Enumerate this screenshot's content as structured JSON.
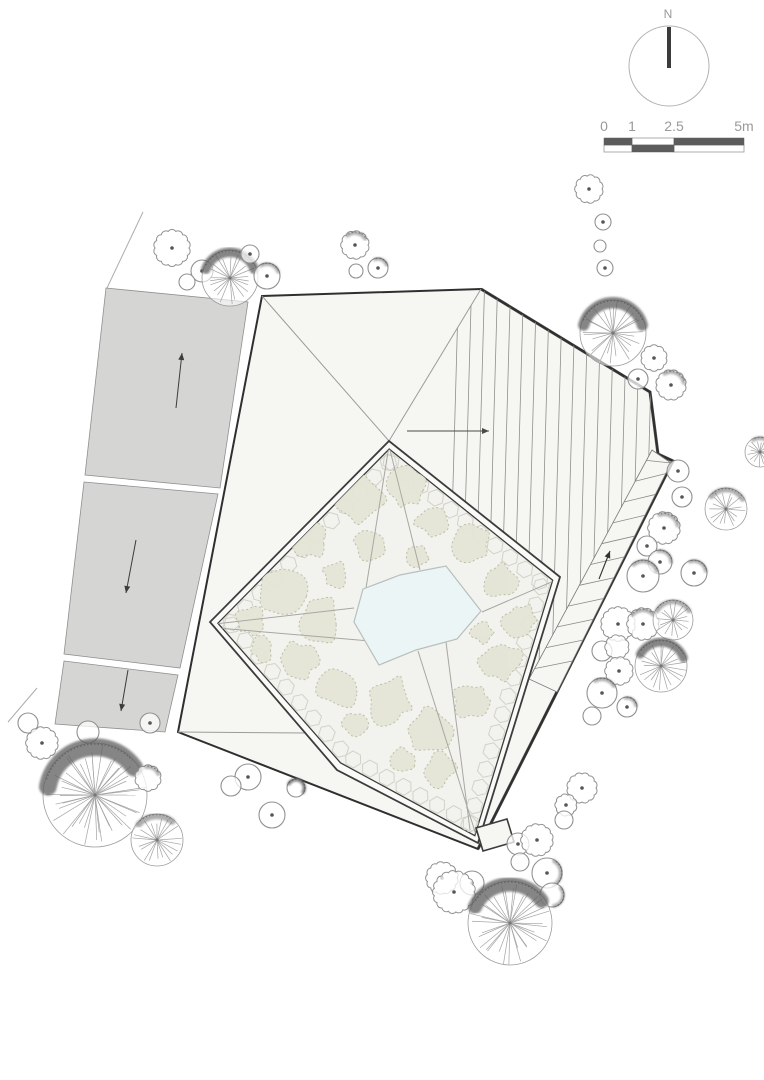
{
  "drawing_type": "architectural site plan / roof plan",
  "north_arrow": {
    "label": "N",
    "cx": 669,
    "cy": 66,
    "r": 40,
    "needle_y1": 27,
    "needle_y2": 68
  },
  "scale_bar": {
    "labels": [
      "0",
      "1",
      "2.5",
      "5m"
    ],
    "label_x": [
      604,
      632,
      674,
      744
    ],
    "label_y": 131,
    "x0": 604,
    "bar_y": 138,
    "row_h": 7,
    "unit_px": 28,
    "dark_cells": [
      {
        "from": 0,
        "to": 1,
        "row": 0
      },
      {
        "from": 1,
        "to": 2.5,
        "row": 1
      },
      {
        "from": 2.5,
        "to": 5,
        "row": 0
      }
    ],
    "light_cells": [
      {
        "from": 1,
        "to": 2.5,
        "row": 0
      },
      {
        "from": 0,
        "to": 1,
        "row": 1
      },
      {
        "from": 2.5,
        "to": 5,
        "row": 1
      }
    ]
  },
  "colors": {
    "background": "#ffffff",
    "road_fill": "#d5d5d3",
    "road_edge": "#8f8f8f",
    "roof_fill": "#f6f6f3",
    "roof_outline": "#2f2f2f",
    "ridge_line": "#9b9b9b",
    "hatch_line": "#8f8f8c",
    "courtyard_fill": "#f2f2ee",
    "wall_fill": "#fafaf8",
    "wall_line": "#3c3c3c",
    "vegetation_fill": "#e4e5d5",
    "vegetation_edge": "#b9bda3",
    "pond_fill": "#ecf5f5",
    "pond_edge": "#b7bfbf",
    "paver_line": "#d2d2c8",
    "tree_line": "#919191",
    "tree_spoke": "#a3a3a3",
    "tree_shade": "#5d5d5d",
    "arrow": "#3c3c3c",
    "scale_dark": "#5c5c5c",
    "scale_frame": "#9a9a9a"
  },
  "boundary_lines": [
    [
      143,
      212,
      107,
      288
    ],
    [
      37,
      688,
      8,
      722
    ]
  ],
  "roads": {
    "segments": [
      {
        "points": [
          [
            106,
            288
          ],
          [
            248,
            302
          ],
          [
            220,
            488
          ],
          [
            85,
            475
          ]
        ],
        "arrow": {
          "x1": 176,
          "y1": 408,
          "x2": 182,
          "y2": 353
        }
      },
      {
        "points": [
          [
            84,
            482
          ],
          [
            218,
            494
          ],
          [
            180,
            668
          ],
          [
            64,
            654
          ]
        ],
        "arrow": {
          "x1": 136,
          "y1": 540,
          "x2": 126,
          "y2": 593
        }
      },
      {
        "points": [
          [
            64,
            661
          ],
          [
            178,
            675
          ],
          [
            165,
            732
          ],
          [
            55,
            724
          ]
        ],
        "arrow": {
          "x1": 128,
          "y1": 670,
          "x2": 121,
          "y2": 711
        }
      }
    ]
  },
  "building": {
    "outer": [
      [
        262,
        296
      ],
      [
        481,
        289
      ],
      [
        650,
        392
      ],
      [
        658,
        454
      ],
      [
        673,
        461
      ],
      [
        478,
        849
      ],
      [
        178,
        732
      ]
    ],
    "heavy_edges": [
      [
        481,
        289
      ],
      [
        650,
        392
      ],
      [
        658,
        454
      ],
      [
        673,
        461
      ],
      [
        478,
        849
      ]
    ],
    "ridges": [
      [
        262,
        296,
        389,
        441
      ],
      [
        481,
        289,
        389,
        441
      ],
      [
        178,
        732,
        305,
        733
      ]
    ],
    "hatch_region": [
      [
        481,
        289
      ],
      [
        650,
        392
      ],
      [
        658,
        454
      ],
      [
        529,
        679
      ],
      [
        560,
        577
      ],
      [
        389,
        441
      ]
    ],
    "hatch_x_from": 455,
    "hatch_x_to": 690,
    "hatch_step": 13,
    "ramp_band": {
      "inner": [
        [
          652,
          450
        ],
        [
          529,
          679
        ]
      ],
      "outer": [
        [
          671,
          463
        ],
        [
          557,
          692
        ]
      ],
      "treads": 11
    },
    "roof_arrow": {
      "x1": 407,
      "y1": 431,
      "x2": 489,
      "y2": 431
    },
    "ramp_arrow": {
      "x1": 599,
      "y1": 579,
      "x2": 610,
      "y2": 551
    },
    "entry_box": [
      [
        476,
        828
      ],
      [
        507,
        819
      ],
      [
        514,
        842
      ],
      [
        483,
        851
      ]
    ]
  },
  "courtyard": {
    "outer_wall": [
      [
        389,
        441
      ],
      [
        560,
        577
      ],
      [
        478,
        843
      ],
      [
        337,
        770
      ],
      [
        210,
        622
      ]
    ],
    "wall_inset": 8,
    "pond": [
      [
        363,
        589
      ],
      [
        400,
        575
      ],
      [
        446,
        566
      ],
      [
        481,
        611
      ],
      [
        457,
        639
      ],
      [
        416,
        650
      ],
      [
        379,
        665
      ],
      [
        354,
        622
      ]
    ],
    "paths": [
      [
        389,
        446,
        420,
        570
      ],
      [
        389,
        446,
        366,
        588
      ],
      [
        215,
        624,
        354,
        608
      ],
      [
        218,
        628,
        370,
        641
      ],
      [
        556,
        580,
        482,
        612
      ],
      [
        477,
        838,
        418,
        651
      ],
      [
        470,
        830,
        446,
        642
      ]
    ],
    "blobs": [
      [
        360,
        500,
        26
      ],
      [
        405,
        487,
        22
      ],
      [
        310,
        540,
        20
      ],
      [
        280,
        590,
        26
      ],
      [
        250,
        620,
        16
      ],
      [
        320,
        620,
        24
      ],
      [
        300,
        660,
        20
      ],
      [
        340,
        690,
        22
      ],
      [
        390,
        700,
        26
      ],
      [
        430,
        730,
        24
      ],
      [
        470,
        700,
        20
      ],
      [
        500,
        660,
        22
      ],
      [
        520,
        620,
        18
      ],
      [
        500,
        580,
        18
      ],
      [
        470,
        545,
        22
      ],
      [
        432,
        520,
        18
      ],
      [
        370,
        545,
        16
      ],
      [
        262,
        648,
        13
      ],
      [
        440,
        770,
        18
      ],
      [
        402,
        762,
        15
      ],
      [
        355,
        725,
        14
      ],
      [
        482,
        632,
        12
      ],
      [
        335,
        575,
        14
      ],
      [
        418,
        555,
        12
      ]
    ]
  },
  "trees": [
    {
      "t": "scallop",
      "x": 589,
      "y": 189,
      "r": 13,
      "dot": 1
    },
    {
      "t": "bush",
      "x": 603,
      "y": 222,
      "r": 8,
      "dot": 1
    },
    {
      "t": "bush",
      "x": 600,
      "y": 246,
      "r": 6,
      "dot": 0
    },
    {
      "t": "bush",
      "x": 605,
      "y": 268,
      "r": 8,
      "dot": 1
    },
    {
      "t": "wheel",
      "x": 613,
      "y": 333,
      "r": 33,
      "shade": [
        -165,
        -15
      ],
      "heavy": 1
    },
    {
      "t": "scallop",
      "x": 654,
      "y": 358,
      "r": 12,
      "dot": 1
    },
    {
      "t": "bush",
      "x": 638,
      "y": 379,
      "r": 10,
      "dot": 1
    },
    {
      "t": "scallop",
      "x": 671,
      "y": 385,
      "r": 14,
      "dot": 1,
      "shade": [
        -120,
        -10
      ]
    },
    {
      "t": "bush",
      "x": 678,
      "y": 471,
      "r": 11,
      "dot": 1
    },
    {
      "t": "bush",
      "x": 682,
      "y": 497,
      "r": 10,
      "dot": 1
    },
    {
      "t": "wheel",
      "x": 726,
      "y": 509,
      "r": 21,
      "shade": [
        -140,
        -30
      ]
    },
    {
      "t": "wheel",
      "x": 760,
      "y": 452,
      "r": 15,
      "shade": [
        -120,
        -20
      ]
    },
    {
      "t": "scallop",
      "x": 664,
      "y": 528,
      "r": 15,
      "dot": 1,
      "shade": [
        -110,
        -10
      ]
    },
    {
      "t": "bush",
      "x": 647,
      "y": 546,
      "r": 10,
      "dot": 1
    },
    {
      "t": "bush",
      "x": 660,
      "y": 562,
      "r": 12,
      "dot": 1,
      "shade": [
        -100,
        0
      ]
    },
    {
      "t": "bush",
      "x": 643,
      "y": 576,
      "r": 16,
      "dot": 1,
      "shade": [
        -130,
        -20
      ]
    },
    {
      "t": "bush",
      "x": 694,
      "y": 573,
      "r": 13,
      "dot": 1,
      "shade": [
        -110,
        -10
      ]
    },
    {
      "t": "scallop",
      "x": 618,
      "y": 624,
      "r": 16,
      "dot": 1
    },
    {
      "t": "scallop",
      "x": 643,
      "y": 624,
      "r": 15,
      "dot": 1,
      "shade": [
        -140,
        -40
      ]
    },
    {
      "t": "wheel",
      "x": 673,
      "y": 620,
      "r": 20,
      "shade": [
        -150,
        -30
      ]
    },
    {
      "t": "bush",
      "x": 602,
      "y": 651,
      "r": 10,
      "dot": 0
    },
    {
      "t": "scallop",
      "x": 617,
      "y": 647,
      "r": 11,
      "dot": 0
    },
    {
      "t": "scallop",
      "x": 619,
      "y": 671,
      "r": 13,
      "dot": 1
    },
    {
      "t": "wheel",
      "x": 661,
      "y": 666,
      "r": 26,
      "shade": [
        -150,
        -20
      ],
      "heavy": 1
    },
    {
      "t": "bush",
      "x": 602,
      "y": 693,
      "r": 15,
      "dot": 1,
      "shade": [
        -120,
        -30
      ]
    },
    {
      "t": "bush",
      "x": 592,
      "y": 716,
      "r": 9,
      "dot": 0
    },
    {
      "t": "bush",
      "x": 627,
      "y": 707,
      "r": 10,
      "dot": 1,
      "shade": [
        -100,
        -10
      ]
    },
    {
      "t": "scallop",
      "x": 582,
      "y": 788,
      "r": 14,
      "dot": 1
    },
    {
      "t": "scallop",
      "x": 566,
      "y": 805,
      "r": 10,
      "dot": 1
    },
    {
      "t": "bush",
      "x": 564,
      "y": 820,
      "r": 9,
      "dot": 0
    },
    {
      "t": "scallop",
      "x": 172,
      "y": 248,
      "r": 17,
      "dot": 1
    },
    {
      "t": "bush",
      "x": 202,
      "y": 271,
      "r": 11,
      "dot": 1
    },
    {
      "t": "bush",
      "x": 187,
      "y": 282,
      "r": 8,
      "dot": 0
    },
    {
      "t": "wheel",
      "x": 230,
      "y": 278,
      "r": 28,
      "shade": [
        -160,
        -20
      ],
      "heavy": 1
    },
    {
      "t": "bush",
      "x": 250,
      "y": 254,
      "r": 9,
      "dot": 1
    },
    {
      "t": "bush",
      "x": 267,
      "y": 276,
      "r": 13,
      "dot": 1,
      "shade": [
        -120,
        -20
      ]
    },
    {
      "t": "scallop",
      "x": 355,
      "y": 245,
      "r": 13,
      "dot": 1,
      "shade": [
        -130,
        -30
      ]
    },
    {
      "t": "bush",
      "x": 378,
      "y": 268,
      "r": 10,
      "dot": 1,
      "shade": [
        -110,
        -20
      ]
    },
    {
      "t": "bush",
      "x": 356,
      "y": 271,
      "r": 7,
      "dot": 0
    },
    {
      "t": "bush",
      "x": 28,
      "y": 723,
      "r": 10,
      "dot": 0
    },
    {
      "t": "scallop",
      "x": 42,
      "y": 743,
      "r": 15,
      "dot": 1
    },
    {
      "t": "bush",
      "x": 88,
      "y": 732,
      "r": 11,
      "dot": 0
    },
    {
      "t": "bush",
      "x": 150,
      "y": 723,
      "r": 10,
      "dot": 1
    },
    {
      "t": "wheel",
      "x": 95,
      "y": 795,
      "r": 52,
      "shade": [
        -170,
        -35
      ],
      "heavy": 1
    },
    {
      "t": "scallop",
      "x": 148,
      "y": 778,
      "r": 12,
      "dot": 0,
      "shade": [
        -100,
        -20
      ]
    },
    {
      "t": "wheel",
      "x": 157,
      "y": 840,
      "r": 26,
      "shade": [
        -140,
        -50
      ]
    },
    {
      "t": "bush",
      "x": 248,
      "y": 777,
      "r": 13,
      "dot": 1
    },
    {
      "t": "bush",
      "x": 231,
      "y": 786,
      "r": 10,
      "dot": 0
    },
    {
      "t": "bush",
      "x": 296,
      "y": 788,
      "r": 9,
      "dot": 0,
      "shade": [
        -150,
        30
      ],
      "heavy": 1
    },
    {
      "t": "bush",
      "x": 272,
      "y": 815,
      "r": 13,
      "dot": 1
    },
    {
      "t": "bush",
      "x": 518,
      "y": 844,
      "r": 11,
      "dot": 1
    },
    {
      "t": "scallop",
      "x": 537,
      "y": 840,
      "r": 15,
      "dot": 1
    },
    {
      "t": "bush",
      "x": 520,
      "y": 862,
      "r": 9,
      "dot": 0
    },
    {
      "t": "bush",
      "x": 547,
      "y": 873,
      "r": 15,
      "dot": 1,
      "shade": [
        -60,
        60
      ]
    },
    {
      "t": "bush",
      "x": 552,
      "y": 895,
      "r": 12,
      "dot": 0,
      "shade": [
        -40,
        80
      ]
    },
    {
      "t": "scallop",
      "x": 442,
      "y": 878,
      "r": 15,
      "dot": 1
    },
    {
      "t": "bush",
      "x": 472,
      "y": 883,
      "r": 12,
      "dot": 1
    },
    {
      "t": "scallop",
      "x": 454,
      "y": 892,
      "r": 20,
      "dot": 1
    },
    {
      "t": "wheel",
      "x": 510,
      "y": 923,
      "r": 42,
      "shade": [
        -155,
        -35
      ],
      "heavy": 1
    }
  ]
}
